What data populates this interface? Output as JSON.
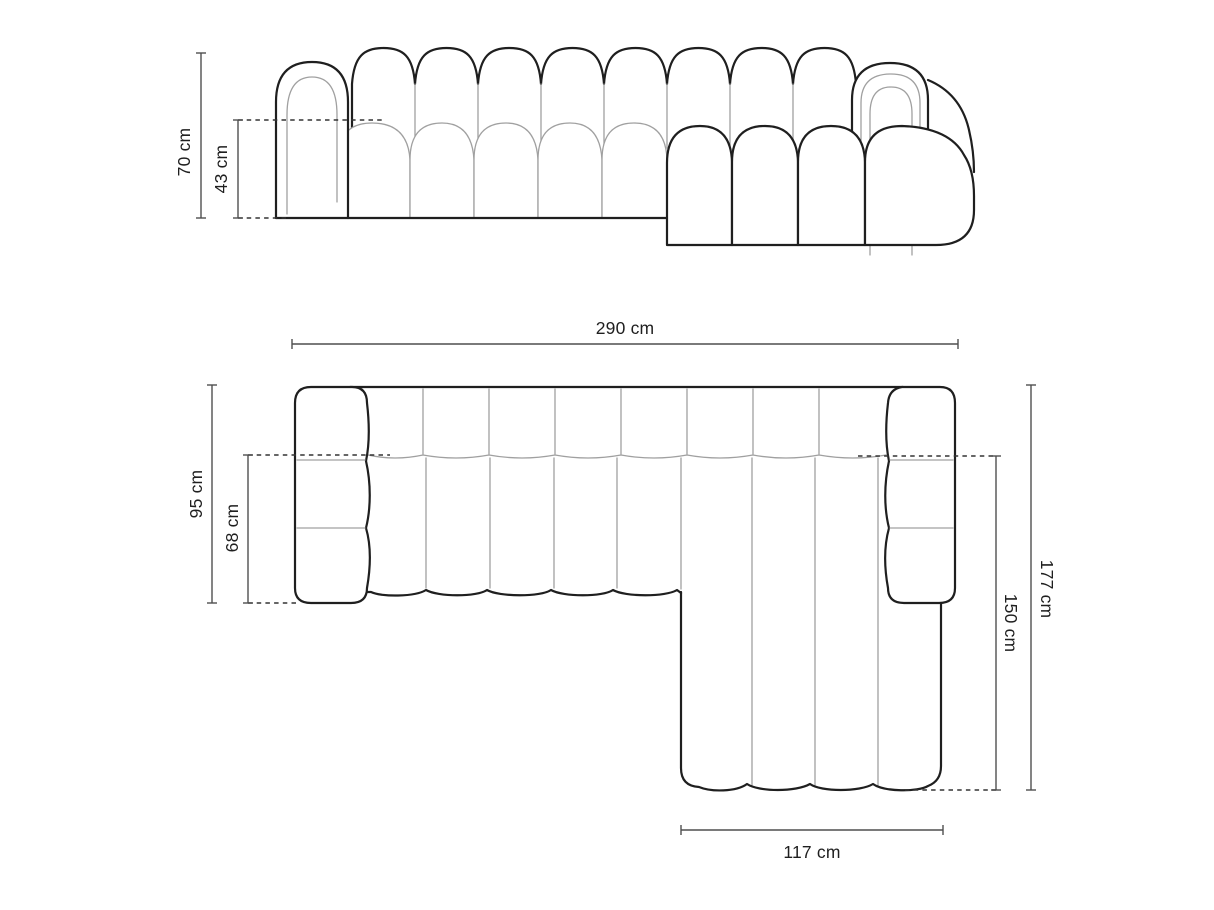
{
  "canvas": {
    "width": 1214,
    "height": 910,
    "background": "#ffffff"
  },
  "colors": {
    "outline_bold": "#1f1f1f",
    "outline_thin": "#a0a0a0",
    "dimension_line": "#4f4f4f",
    "dashed_line": "#333333",
    "label_text": "#1f1f1f"
  },
  "front_view": {
    "overall_height": {
      "label": "70 cm"
    },
    "seat_height": {
      "label": "43 cm"
    }
  },
  "top_view": {
    "overall_width": {
      "label": "290 cm"
    },
    "body_depth": {
      "label": "95 cm"
    },
    "seat_depth": {
      "label": "68 cm"
    },
    "overall_depth": {
      "label": "177 cm"
    },
    "chaise_depth": {
      "label": "150 cm"
    },
    "chaise_width": {
      "label": "117 cm"
    }
  }
}
